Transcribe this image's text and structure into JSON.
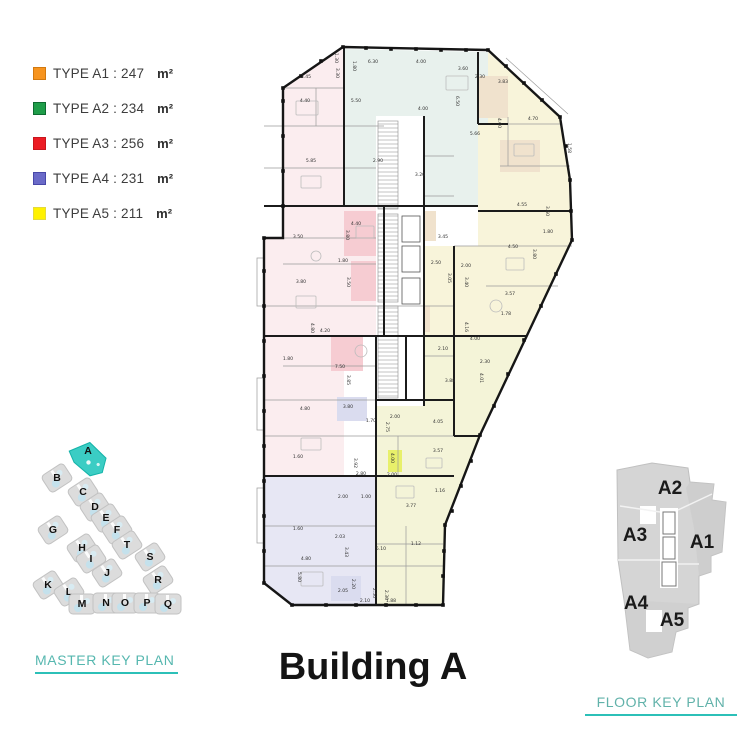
{
  "page": {
    "title": "Building A"
  },
  "legend": {
    "unit": "m²",
    "items": [
      {
        "label": "TYPE A1 : 247",
        "color": "#F7941E",
        "border": "#D2790F"
      },
      {
        "label": "TYPE A2 : 234",
        "color": "#1F9D49",
        "border": "#0E6B31"
      },
      {
        "label": "TYPE A3 : 256",
        "color": "#EC1C24",
        "border": "#C8161D"
      },
      {
        "label": "TYPE A4 : 231",
        "color": "#6A6AC8",
        "border": "#4848A8"
      },
      {
        "label": "TYPE A5 : 211",
        "color": "#FFF100",
        "border": "#E4DA3C"
      }
    ]
  },
  "master_key_plan": {
    "heading": "MASTER KEY PLAN",
    "highlight_color": "#3BCDC4",
    "buildings": [
      {
        "label": "A",
        "x": 58,
        "y": 26,
        "highlighted": true,
        "rot": -33
      },
      {
        "label": "B",
        "x": 27,
        "y": 46,
        "highlighted": false,
        "rot": -33
      },
      {
        "label": "C",
        "x": 53,
        "y": 60,
        "highlighted": false,
        "rot": -33
      },
      {
        "label": "D",
        "x": 65,
        "y": 75,
        "highlighted": false,
        "rot": -33
      },
      {
        "label": "E",
        "x": 76,
        "y": 86,
        "highlighted": false,
        "rot": -33
      },
      {
        "label": "F",
        "x": 87,
        "y": 98,
        "highlighted": false,
        "rot": -33
      },
      {
        "label": "G",
        "x": 23,
        "y": 98,
        "highlighted": false,
        "rot": -33
      },
      {
        "label": "H",
        "x": 52,
        "y": 116,
        "highlighted": false,
        "rot": -33
      },
      {
        "label": "I",
        "x": 61,
        "y": 127,
        "highlighted": false,
        "rot": -33
      },
      {
        "label": "J",
        "x": 77,
        "y": 141,
        "highlighted": false,
        "rot": -33
      },
      {
        "label": "T",
        "x": 97,
        "y": 113,
        "highlighted": false,
        "rot": -33
      },
      {
        "label": "S",
        "x": 120,
        "y": 125,
        "highlighted": false,
        "rot": -33
      },
      {
        "label": "R",
        "x": 128,
        "y": 148,
        "highlighted": false,
        "rot": -33
      },
      {
        "label": "K",
        "x": 18,
        "y": 153,
        "highlighted": false,
        "rot": -33
      },
      {
        "label": "L",
        "x": 39,
        "y": 160,
        "highlighted": false,
        "rot": -33
      },
      {
        "label": "M",
        "x": 52,
        "y": 172,
        "highlighted": false,
        "rot": 0
      },
      {
        "label": "N",
        "x": 76,
        "y": 171,
        "highlighted": false,
        "rot": 0
      },
      {
        "label": "O",
        "x": 95,
        "y": 171,
        "highlighted": false,
        "rot": 0
      },
      {
        "label": "P",
        "x": 117,
        "y": 171,
        "highlighted": false,
        "rot": 0
      },
      {
        "label": "Q",
        "x": 138,
        "y": 172,
        "highlighted": false,
        "rot": 0
      }
    ]
  },
  "floor_key_plan": {
    "heading": "FLOOR KEY PLAN",
    "units": [
      {
        "label": "A2",
        "x": 72,
        "y": 46
      },
      {
        "label": "A3",
        "x": 37,
        "y": 93
      },
      {
        "label": "A1",
        "x": 104,
        "y": 100
      },
      {
        "label": "A4",
        "x": 38,
        "y": 161
      },
      {
        "label": "A5",
        "x": 74,
        "y": 178
      }
    ]
  },
  "floor_plan": {
    "name": "Building A typical floor plan",
    "unit_colors": {
      "A1": "#F8F4DA",
      "A2": "#E8F1ED",
      "A3": "#FBEDEF",
      "A4": "#E7E7F4",
      "A5": "#F4F4D8",
      "accent_pink": "#F6CCD2",
      "accent_tan": "#F0E2CD",
      "accent_lav": "#DADCEF",
      "accent_lime": "#E8F06A"
    },
    "dimensions": [
      {
        "t": "1.30",
        "x": 79,
        "y": 52,
        "r": 90
      },
      {
        "t": "3.30",
        "x": 80,
        "y": 67,
        "r": 90
      },
      {
        "t": "6.30",
        "x": 117,
        "y": 57
      },
      {
        "t": "1.80",
        "x": 97,
        "y": 60,
        "r": 90
      },
      {
        "t": "4.00",
        "x": 165,
        "y": 57
      },
      {
        "t": "3.60",
        "x": 207,
        "y": 64
      },
      {
        "t": "3.83",
        "x": 247,
        "y": 77
      },
      {
        "t": "2.30",
        "x": 224,
        "y": 72
      },
      {
        "t": "3.45",
        "x": 50,
        "y": 72
      },
      {
        "t": "4.40",
        "x": 49,
        "y": 96
      },
      {
        "t": "5.50",
        "x": 100,
        "y": 96
      },
      {
        "t": "4.00",
        "x": 167,
        "y": 104
      },
      {
        "t": "6.50",
        "x": 200,
        "y": 95,
        "r": 90
      },
      {
        "t": "2.90",
        "x": 122,
        "y": 156
      },
      {
        "t": "3.20",
        "x": 164,
        "y": 170
      },
      {
        "t": "5.66",
        "x": 219,
        "y": 129
      },
      {
        "t": "4.00",
        "x": 242,
        "y": 117,
        "r": 90
      },
      {
        "t": "4.70",
        "x": 277,
        "y": 114
      },
      {
        "t": "1.58",
        "x": 312,
        "y": 142,
        "r": 90
      },
      {
        "t": "5.85",
        "x": 55,
        "y": 156
      },
      {
        "t": "4.55",
        "x": 266,
        "y": 200
      },
      {
        "t": "3.60",
        "x": 290,
        "y": 205,
        "r": 90
      },
      {
        "t": "4.40",
        "x": 100,
        "y": 219
      },
      {
        "t": "3.80",
        "x": 90,
        "y": 229,
        "r": 90
      },
      {
        "t": "3.50",
        "x": 42,
        "y": 232
      },
      {
        "t": "1.80",
        "x": 87,
        "y": 256
      },
      {
        "t": "3.50",
        "x": 91,
        "y": 276,
        "r": 90
      },
      {
        "t": "3.80",
        "x": 45,
        "y": 277
      },
      {
        "t": "3.45",
        "x": 187,
        "y": 232
      },
      {
        "t": "2.50",
        "x": 180,
        "y": 258
      },
      {
        "t": "3.05",
        "x": 192,
        "y": 272,
        "r": 90
      },
      {
        "t": "2.00",
        "x": 210,
        "y": 261
      },
      {
        "t": "3.40",
        "x": 209,
        "y": 276,
        "r": 90
      },
      {
        "t": "4.50",
        "x": 257,
        "y": 242
      },
      {
        "t": "3.80",
        "x": 277,
        "y": 248,
        "r": 90
      },
      {
        "t": "1.80",
        "x": 292,
        "y": 227
      },
      {
        "t": "3.57",
        "x": 254,
        "y": 289
      },
      {
        "t": "1.78",
        "x": 250,
        "y": 309
      },
      {
        "t": "4.00",
        "x": 219,
        "y": 334
      },
      {
        "t": "4.16",
        "x": 209,
        "y": 321,
        "r": 90
      },
      {
        "t": "2.10",
        "x": 187,
        "y": 344
      },
      {
        "t": "2.30",
        "x": 229,
        "y": 357
      },
      {
        "t": "4.01",
        "x": 224,
        "y": 372,
        "r": 90
      },
      {
        "t": "3.88",
        "x": 194,
        "y": 376
      },
      {
        "t": "4.20",
        "x": 69,
        "y": 326
      },
      {
        "t": "4.80",
        "x": 55,
        "y": 322,
        "r": 90
      },
      {
        "t": "7.50",
        "x": 84,
        "y": 362
      },
      {
        "t": "3.85",
        "x": 91,
        "y": 374,
        "r": 90
      },
      {
        "t": "1.80",
        "x": 32,
        "y": 354
      },
      {
        "t": "4.80",
        "x": 49,
        "y": 404
      },
      {
        "t": "3.80",
        "x": 92,
        "y": 402
      },
      {
        "t": "1.70",
        "x": 115,
        "y": 416
      },
      {
        "t": "2.75",
        "x": 130,
        "y": 421,
        "r": 90
      },
      {
        "t": "2.00",
        "x": 139,
        "y": 412
      },
      {
        "t": "4.05",
        "x": 182,
        "y": 417
      },
      {
        "t": "1.60",
        "x": 42,
        "y": 452
      },
      {
        "t": "2.80",
        "x": 105,
        "y": 469
      },
      {
        "t": "3.92",
        "x": 98,
        "y": 457,
        "r": 90
      },
      {
        "t": "4.00",
        "x": 135,
        "y": 452,
        "r": 90
      },
      {
        "t": "2.00",
        "x": 136,
        "y": 470
      },
      {
        "t": "3.57",
        "x": 182,
        "y": 446
      },
      {
        "t": "1.16",
        "x": 184,
        "y": 486
      },
      {
        "t": "2.00",
        "x": 87,
        "y": 492
      },
      {
        "t": "1.00",
        "x": 110,
        "y": 492
      },
      {
        "t": "3.77",
        "x": 155,
        "y": 501
      },
      {
        "t": "1.60",
        "x": 42,
        "y": 524
      },
      {
        "t": "3.43",
        "x": 89,
        "y": 546,
        "r": 90
      },
      {
        "t": "2.03",
        "x": 84,
        "y": 532
      },
      {
        "t": "5.10",
        "x": 125,
        "y": 544
      },
      {
        "t": "1.12",
        "x": 160,
        "y": 539
      },
      {
        "t": "4.80",
        "x": 50,
        "y": 554
      },
      {
        "t": "5.80",
        "x": 42,
        "y": 571,
        "r": 90
      },
      {
        "t": "2.05",
        "x": 87,
        "y": 586
      },
      {
        "t": "2.20",
        "x": 96,
        "y": 578,
        "r": 90
      },
      {
        "t": "2.50",
        "x": 117,
        "y": 587,
        "r": 90
      },
      {
        "t": "2.10",
        "x": 109,
        "y": 596
      },
      {
        "t": "1.88",
        "x": 135,
        "y": 596
      },
      {
        "t": "2.30",
        "x": 129,
        "y": 589,
        "r": 90
      }
    ]
  }
}
